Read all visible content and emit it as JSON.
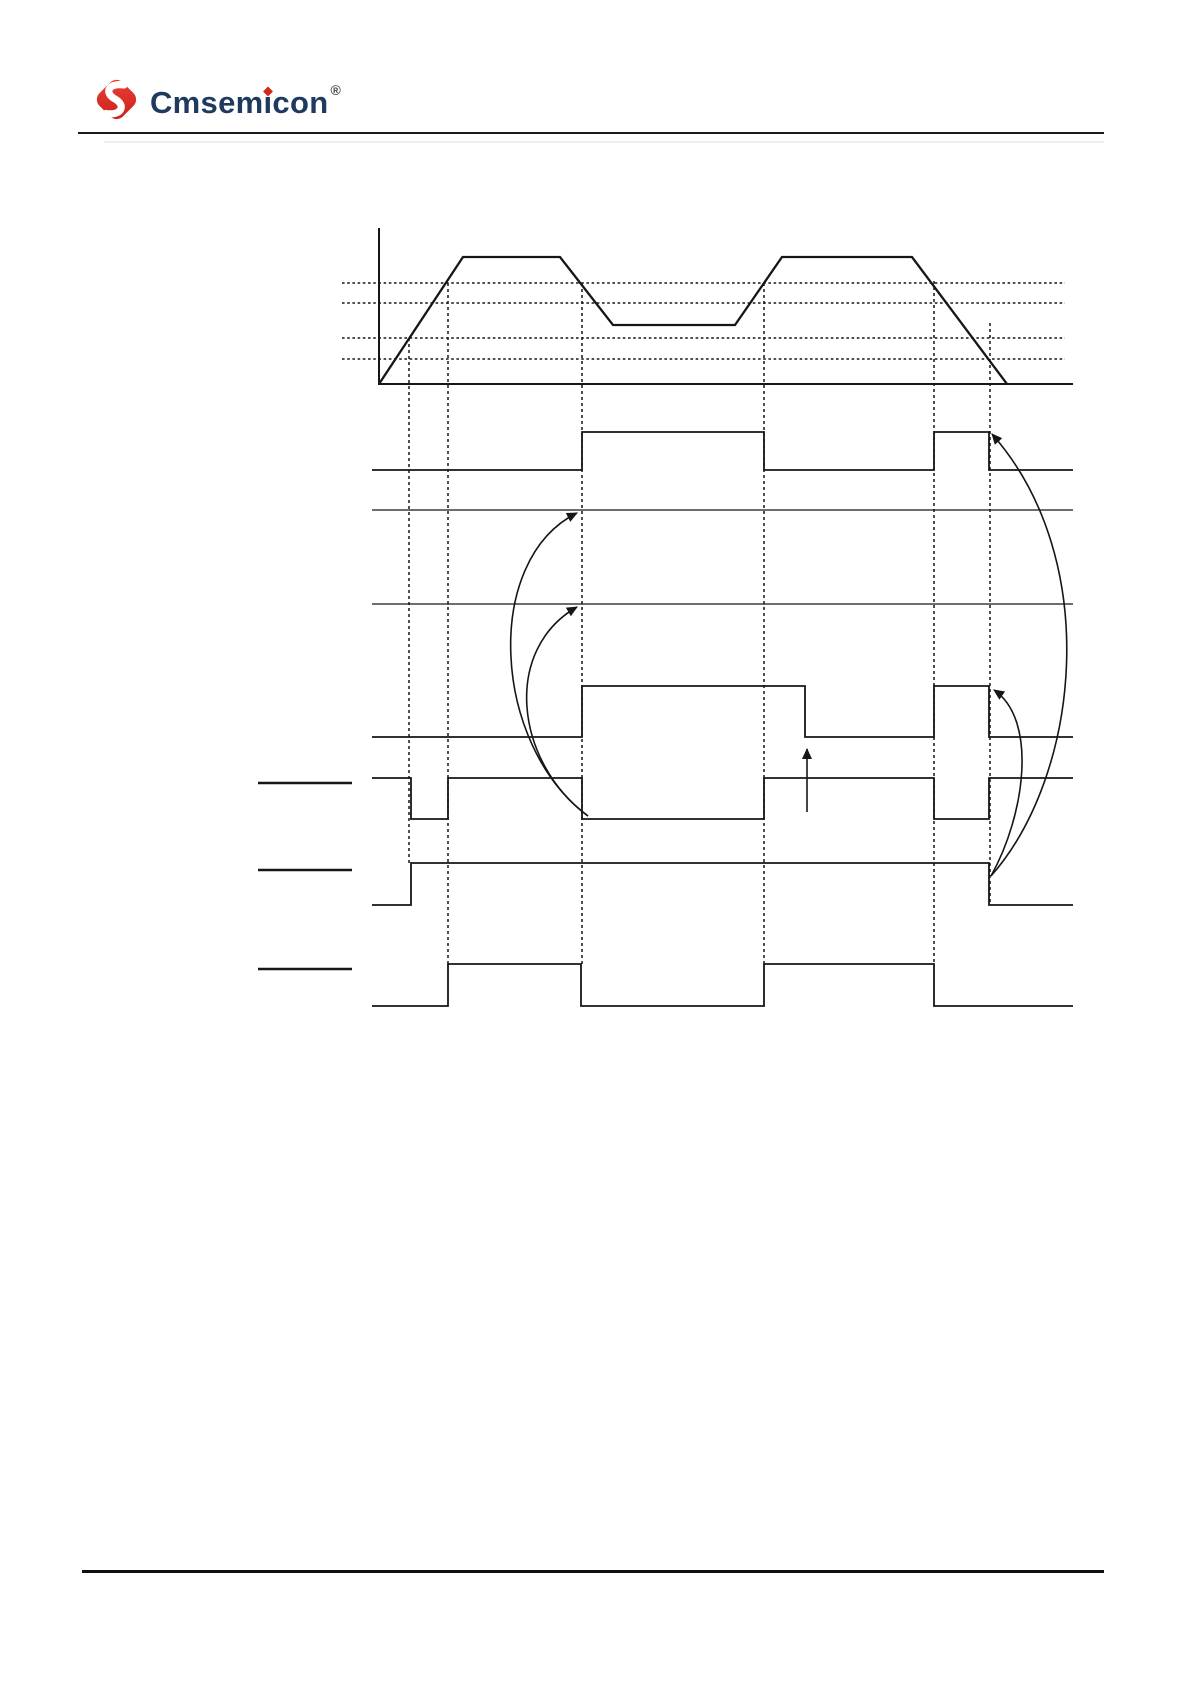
{
  "page": {
    "width": 1190,
    "height": 1684
  },
  "colors": {
    "brand_navy": "#1e3a5e",
    "logo_red": "#da251c",
    "logo_red_light": "#ef4136",
    "diagram_stroke": "#161616",
    "rule_dark": "#1b1b1b",
    "footer_rule": "#101010"
  },
  "header": {
    "brand_pre": "Cmsem",
    "brand_i": "i",
    "brand_post": "con",
    "registered": "®"
  },
  "diagram": {
    "stroke": "#161616",
    "polylines": [
      {
        "name": "analog-y-axis",
        "w": 2,
        "pts": [
          [
            379,
            228
          ],
          [
            379,
            385
          ]
        ]
      },
      {
        "name": "analog-baseline",
        "w": 2,
        "pts": [
          [
            379,
            384
          ],
          [
            1073,
            384
          ]
        ]
      },
      {
        "name": "carrier-wave",
        "w": 2.3,
        "pts": [
          [
            379,
            384
          ],
          [
            463,
            257
          ],
          [
            560,
            257
          ],
          [
            613,
            325
          ],
          [
            735,
            325
          ],
          [
            782,
            257
          ],
          [
            912,
            257
          ],
          [
            1007,
            384
          ]
        ]
      },
      {
        "name": "digital-signal-1",
        "w": 1.8,
        "pts": [
          [
            372,
            470
          ],
          [
            582,
            470
          ],
          [
            582,
            432
          ],
          [
            764,
            432
          ],
          [
            764,
            470
          ],
          [
            934,
            470
          ],
          [
            934,
            432
          ],
          [
            989,
            432
          ],
          [
            989,
            470
          ],
          [
            1073,
            470
          ]
        ]
      },
      {
        "name": "reference-line-1",
        "w": 1.3,
        "pts": [
          [
            372,
            510
          ],
          [
            1073,
            510
          ]
        ]
      },
      {
        "name": "reference-line-2",
        "w": 1.3,
        "pts": [
          [
            372,
            604
          ],
          [
            1073,
            604
          ]
        ]
      },
      {
        "name": "digital-signal-2",
        "w": 1.8,
        "pts": [
          [
            372,
            737
          ],
          [
            582,
            737
          ],
          [
            582,
            686
          ],
          [
            805,
            686
          ],
          [
            805,
            737
          ],
          [
            934,
            737
          ],
          [
            934,
            686
          ],
          [
            989,
            686
          ],
          [
            989,
            737
          ],
          [
            1073,
            737
          ]
        ]
      },
      {
        "name": "digital-signal-3",
        "w": 1.8,
        "pts": [
          [
            372,
            778
          ],
          [
            411,
            778
          ],
          [
            411,
            819
          ],
          [
            448,
            819
          ],
          [
            448,
            778
          ],
          [
            582,
            778
          ],
          [
            582,
            819
          ],
          [
            764,
            819
          ],
          [
            764,
            778
          ],
          [
            934,
            778
          ],
          [
            934,
            819
          ],
          [
            989,
            819
          ],
          [
            989,
            778
          ],
          [
            1073,
            778
          ]
        ]
      },
      {
        "name": "digital-signal-4",
        "w": 1.8,
        "pts": [
          [
            372,
            905
          ],
          [
            411,
            905
          ],
          [
            411,
            863
          ],
          [
            989,
            863
          ],
          [
            989,
            905
          ],
          [
            1073,
            905
          ]
        ]
      },
      {
        "name": "digital-signal-5",
        "w": 1.8,
        "pts": [
          [
            372,
            1006
          ],
          [
            448,
            1006
          ],
          [
            448,
            964
          ],
          [
            581,
            964
          ],
          [
            581,
            1006
          ],
          [
            764,
            1006
          ],
          [
            764,
            964
          ],
          [
            934,
            964
          ],
          [
            934,
            1006
          ],
          [
            1073,
            1006
          ]
        ]
      },
      {
        "name": "label-stub-1",
        "w": 2.6,
        "pts": [
          [
            258,
            783
          ],
          [
            352,
            783
          ]
        ]
      },
      {
        "name": "label-stub-2",
        "w": 2.6,
        "pts": [
          [
            258,
            870
          ],
          [
            352,
            870
          ]
        ]
      },
      {
        "name": "label-stub-3",
        "w": 2.6,
        "pts": [
          [
            258,
            969
          ],
          [
            352,
            969
          ]
        ]
      }
    ],
    "dotted_h": [
      {
        "name": "threshold-line-1",
        "y": 283,
        "x1": 342,
        "x2": 1065
      },
      {
        "name": "threshold-line-2",
        "y": 303,
        "x1": 342,
        "x2": 1065
      },
      {
        "name": "threshold-line-3",
        "y": 338,
        "x1": 342,
        "x2": 1065
      },
      {
        "name": "threshold-line-4",
        "y": 359,
        "x1": 342,
        "x2": 1065
      }
    ],
    "dotted_v": [
      {
        "name": "event-line-1",
        "x": 409,
        "y1": 338,
        "y2": 863
      },
      {
        "name": "event-line-2",
        "x": 448,
        "y1": 283,
        "y2": 964
      },
      {
        "name": "event-line-3",
        "x": 582,
        "y1": 283,
        "y2": 964
      },
      {
        "name": "event-line-4",
        "x": 764,
        "y1": 283,
        "y2": 964
      },
      {
        "name": "event-line-5",
        "x": 934,
        "y1": 281,
        "y2": 964
      },
      {
        "name": "event-line-6",
        "x": 990,
        "y1": 323,
        "y2": 904
      }
    ],
    "arcs": [
      {
        "name": "update-arrow-left-outer",
        "d": "M588,816 C492,745 482,560 577,513"
      },
      {
        "name": "update-arrow-left-inner",
        "d": "M588,816 C515,762 502,650 577,607"
      },
      {
        "name": "update-arrow-right-outer",
        "d": "M991,876 C1080,775 1103,560 992,434"
      },
      {
        "name": "update-arrow-right-inner",
        "d": "M991,876 C1025,815 1038,720 994,690"
      }
    ],
    "straight_arrows": [
      {
        "name": "trigger-arrow-up",
        "x1": 807,
        "y1": 812,
        "x2": 807,
        "y2": 749
      }
    ]
  }
}
